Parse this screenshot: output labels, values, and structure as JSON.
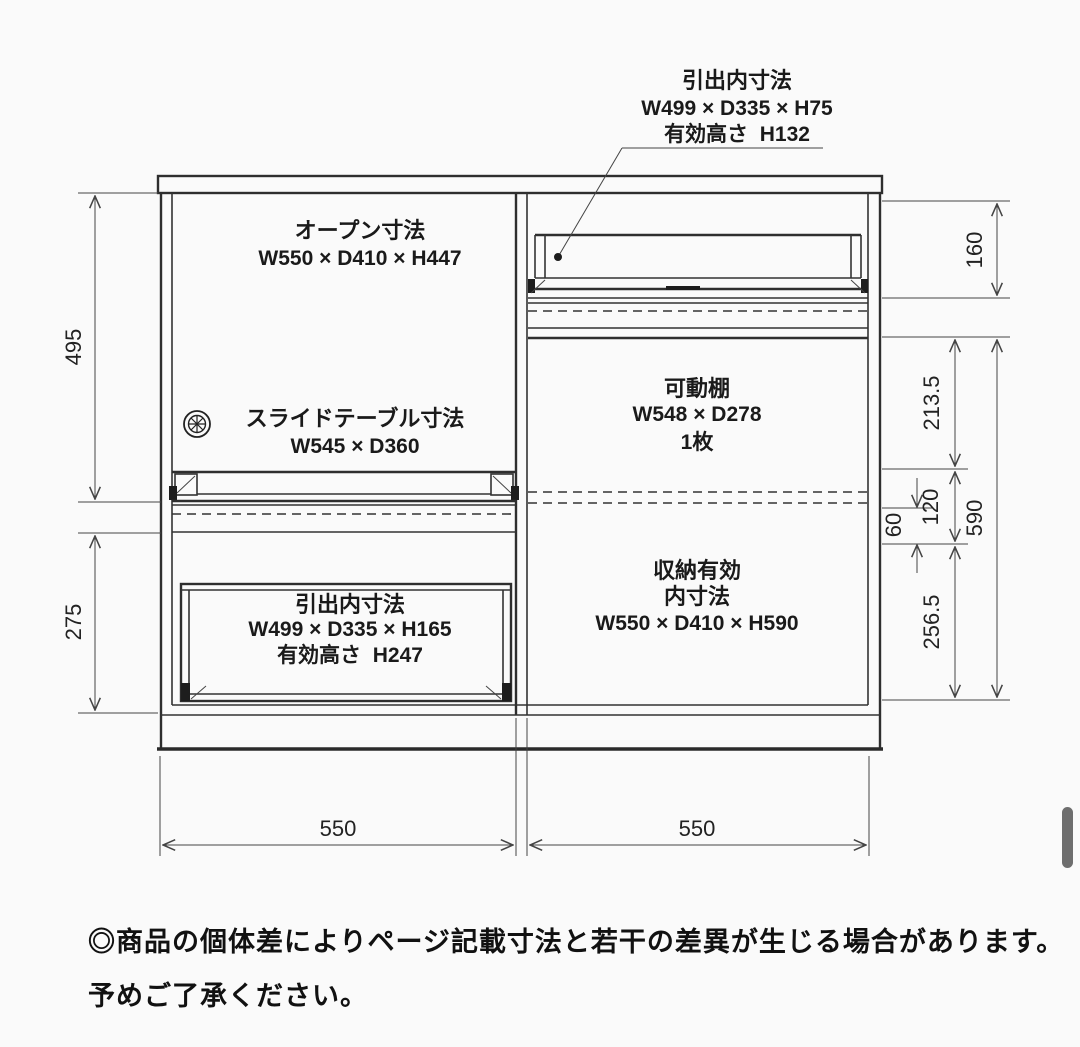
{
  "colors": {
    "line": "#333333",
    "text": "#1a1a1a",
    "background": "#fafafa",
    "scrollbar_thumb": "#6e6e6e"
  },
  "icons": {
    "knob": "circular-knob-icon"
  },
  "callout_top_drawer": {
    "title": "引出内寸法",
    "size": "W499 × D335 × H75",
    "effective_height": "有効高さ  H132"
  },
  "open_section": {
    "title": "オープン寸法",
    "size": "W550 × D410 × H447"
  },
  "slide_table": {
    "title": "スライドテーブル寸法",
    "size": "W545 × D360"
  },
  "bottom_drawer": {
    "title": "引出内寸法",
    "size": "W499 × D335 × H165",
    "effective_height": "有効高さ  H247"
  },
  "movable_shelf": {
    "title": "可動棚",
    "size": "W548 × D278",
    "count": "1枚"
  },
  "storage": {
    "title_line1": "収納有効",
    "title_line2": "内寸法",
    "size": "W550 × D410 × H590"
  },
  "dims": {
    "left_upper": "495",
    "left_lower": "275",
    "right_flap": "160",
    "right_upper": "213.5",
    "right_pitch": "120",
    "right_step": "60",
    "right_lower": "256.5",
    "right_total": "590",
    "width_left": "550",
    "width_right": "550"
  },
  "disclaimer": {
    "line1": "◎商品の個体差によりページ記載寸法と若干の差異が生じる場合があります。",
    "line2": "予めご了承ください。"
  }
}
